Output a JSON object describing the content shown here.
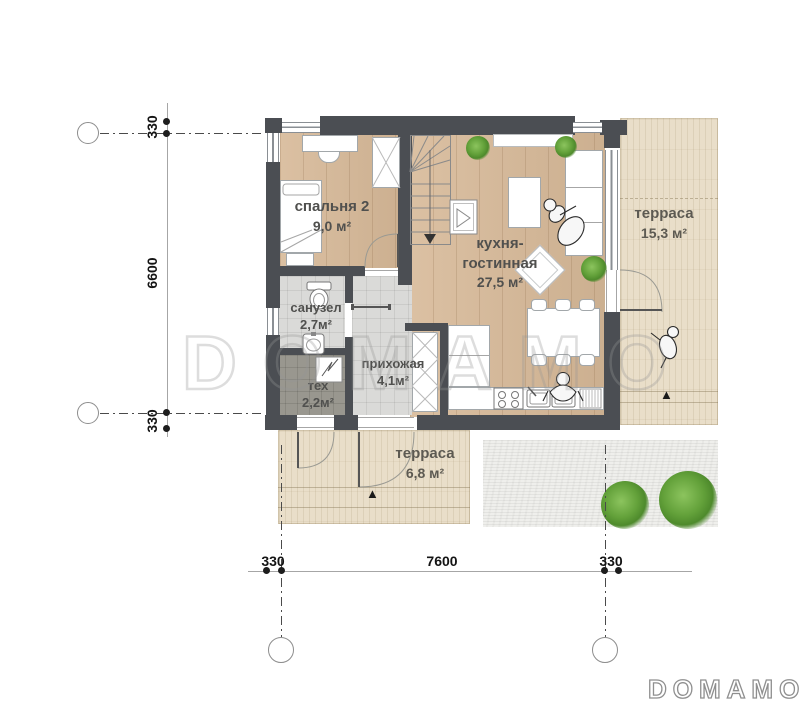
{
  "plan": {
    "rooms": [
      {
        "name": "спальня 2",
        "area": "9,0 м²"
      },
      {
        "name": "кухня-гостинная",
        "area": "27,5 м²"
      },
      {
        "name": "санузел",
        "area": "2,7м²"
      },
      {
        "name": "тех",
        "area": "2,2м²"
      },
      {
        "name": "прихожая",
        "area": "4,1м²"
      },
      {
        "name": "терраса",
        "area": "15,3 м²"
      },
      {
        "name": "терраса",
        "area": "6,8 м²"
      }
    ]
  },
  "dimensions": {
    "left": [
      "330",
      "6600",
      "330"
    ],
    "bottom": [
      "330",
      "7600",
      "330"
    ]
  },
  "watermark": {
    "center": "DOMAMO",
    "logo": "DOMAMO"
  },
  "markers": {
    "entry_triangle": "▲"
  },
  "colors": {
    "wall": "#4b4e53",
    "wood": "#d7b998",
    "tile": "#dadad8",
    "terrace": "#e9dec9",
    "plant": "#63a13a"
  }
}
